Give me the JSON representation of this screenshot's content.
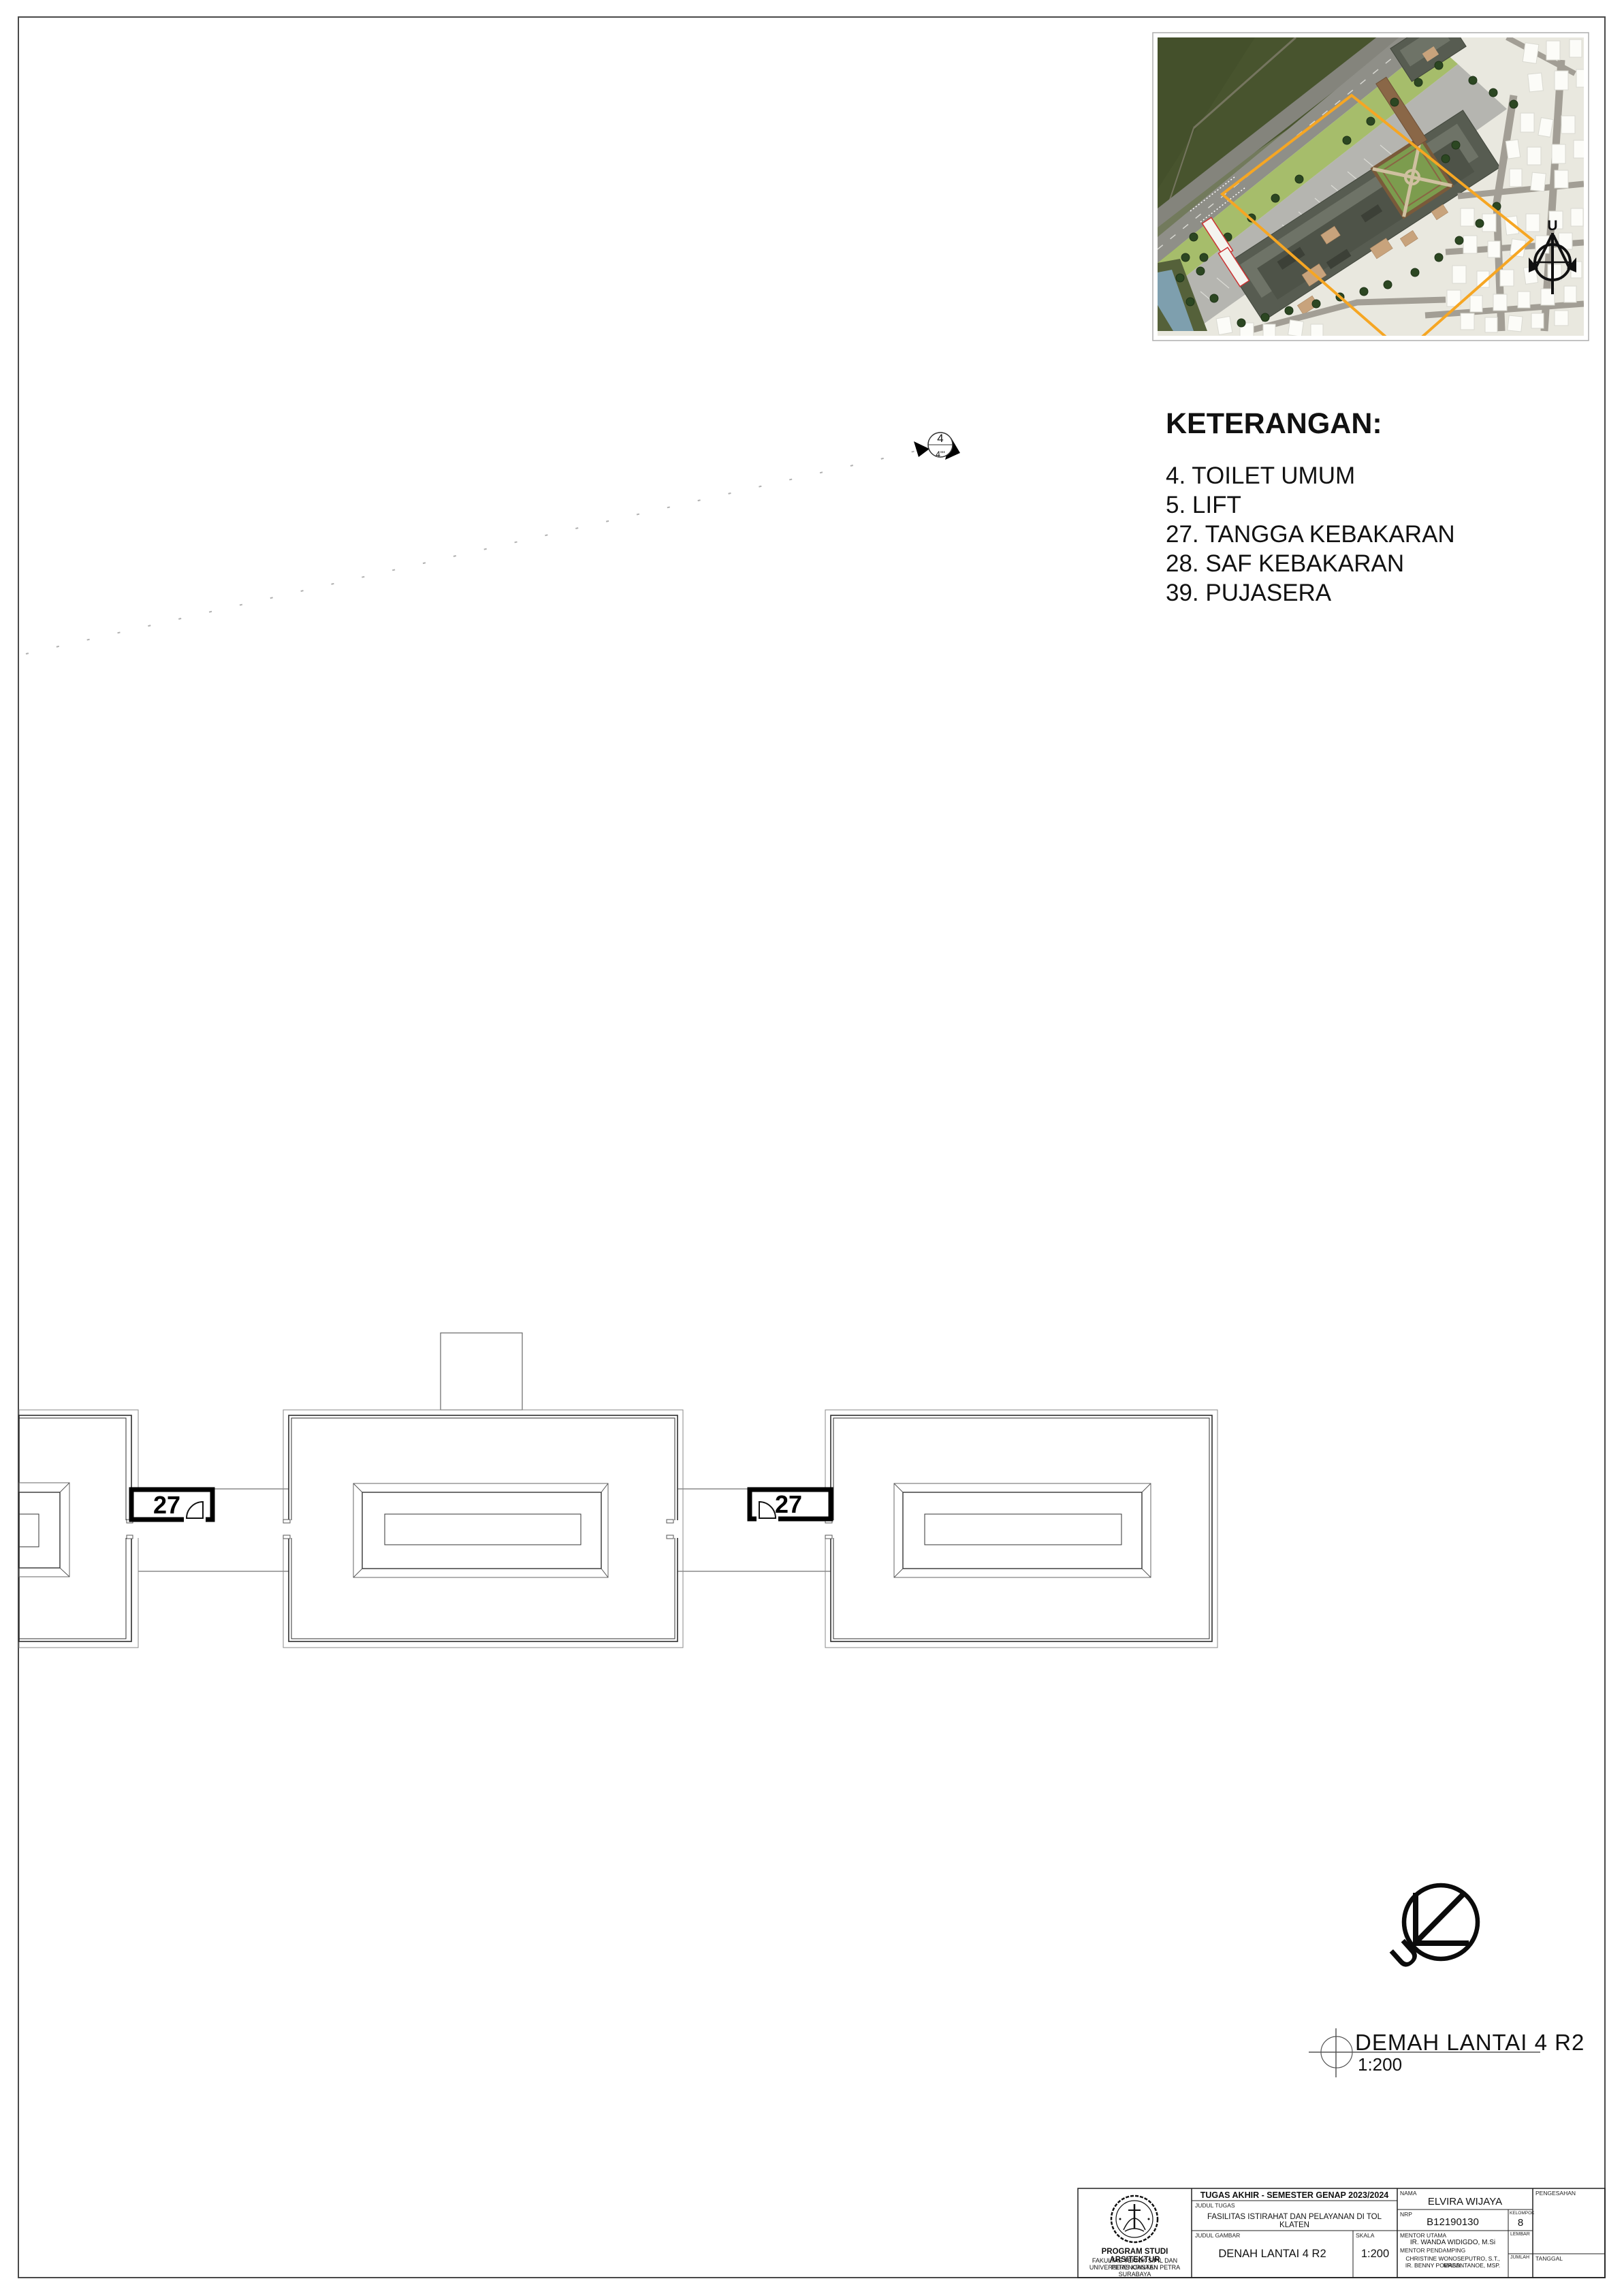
{
  "legend": {
    "title": "KETERANGAN:",
    "items": [
      "4. TOILET UMUM",
      "5. LIFT",
      "27. TANGGA KEBAKARAN",
      "28. SAF KEBAKARAN",
      "39. PUJASERA"
    ]
  },
  "plan": {
    "stair_label_1": "27",
    "stair_label_2": "27"
  },
  "section_marker": {
    "top_label": "4",
    "bottom_label": "4'''"
  },
  "north_arrow": {
    "label": "U"
  },
  "site_map": {
    "north_label": "U"
  },
  "drawing_title": {
    "title": "DEMAH LANTAI 4 R2",
    "scale": "1:200"
  },
  "title_block": {
    "course_header": "TUGAS AKHIR - SEMESTER GENAP 2023/2024",
    "judul_tugas_label": "JUDUL TUGAS",
    "judul_tugas": "FASILITAS ISTIRAHAT DAN PELAYANAN DI TOL KLATEN",
    "judul_gambar_label": "JUDUL GAMBAR",
    "judul_gambar": "DENAH LANTAI 4 R2",
    "skala_label": "SKALA",
    "skala": "1:200",
    "nama_label": "NAMA",
    "nama": "ELVIRA WIJAYA",
    "nrp_label": "NRP",
    "nrp": "B12190130",
    "kelompok_label": "KELOMPOK",
    "kelompok": "8",
    "mentor_utama_label": "MENTOR UTAMA",
    "mentor_utama": "IR. WANDA WIDIGDO, M.Si",
    "mentor_pendamping_label": "MENTOR PENDAMPING",
    "mentor_pendamping_1": "CHRISTINE WONOSEPUTRO, S.T., MASD.",
    "mentor_pendamping_2": "IR. BENNY POERBANTANOE, MSP.",
    "lembar_label": "LEMBAR",
    "jumlah_label": "JUMLAH",
    "tanggal_label": "TANGGAL",
    "pengesahan_label": "PENGESAHAN",
    "institution": {
      "line1": "PROGRAM STUDI ARSITEKTUR",
      "line2": "FAKULTAS TEKNIK SIPIL DAN PERENCANAAN",
      "line3": "UNIVERSITAS KRISTEN PETRA",
      "line4": "SURABAYA"
    }
  },
  "colors": {
    "boundary_orange": "#F6A623",
    "plan_line": "#2F2F2F",
    "roof_line": "#8A8A8A",
    "field_green": "#44502B",
    "lawn_green": "#A6BD6B",
    "building_gray": "#575C51",
    "road_gray": "#8F8F88",
    "water_blue": "#7E9FAE",
    "red_outline": "#CC3333"
  }
}
